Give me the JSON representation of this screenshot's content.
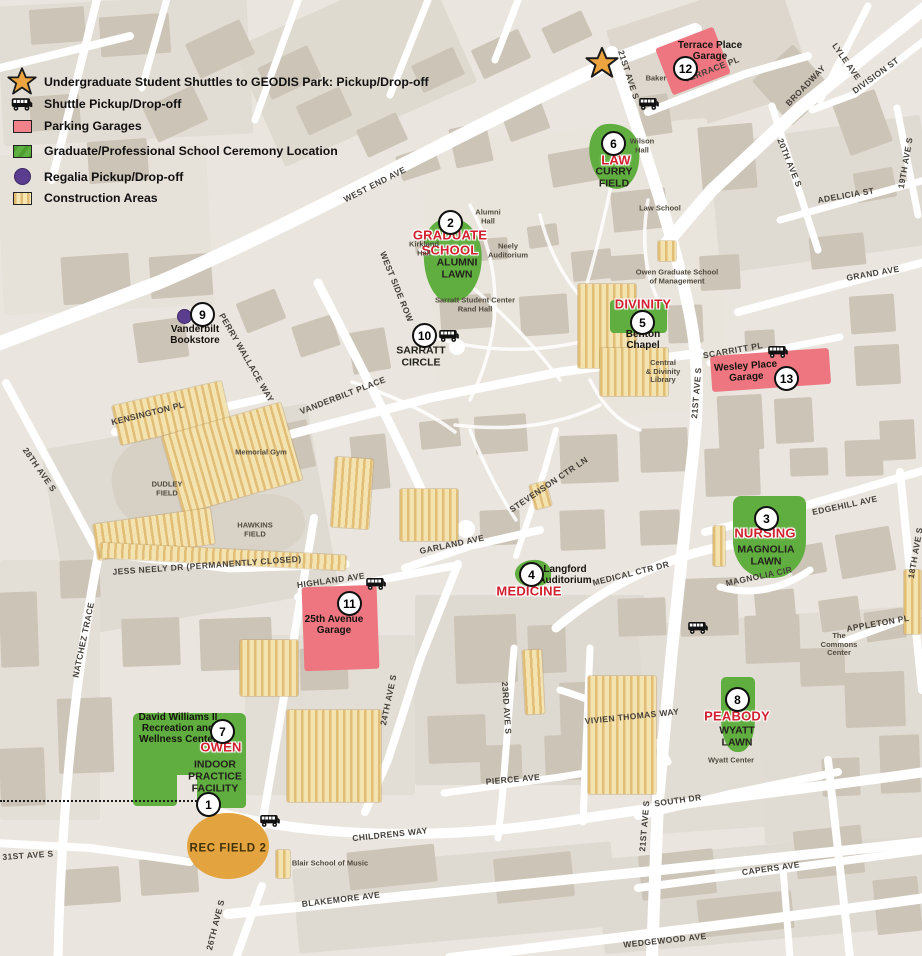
{
  "colors": {
    "ceremony_green": "#5fae3f",
    "garage_pink": "#ee7680",
    "field_orange": "#e3a33e",
    "regalia_purple": "#5b3d8f",
    "star_orange": "#eba43f",
    "red_label": "#d1202f",
    "construction_tan": "#f3e3b1",
    "construction_stripe": "#e1bd75"
  },
  "legend": {
    "items": [
      {
        "icon": "star",
        "label": "Undergraduate Student Shuttles to GEODIS Park: Pickup/Drop-off"
      },
      {
        "icon": "shuttle",
        "label": "Shuttle Pickup/Drop-off"
      },
      {
        "icon": "parking",
        "label": "Parking Garages"
      },
      {
        "icon": "ceremony",
        "label": "Graduate/Professional School Ceremony Location"
      },
      {
        "icon": "regalia",
        "label": "Regalia Pickup/Drop-off"
      },
      {
        "icon": "construction",
        "label": "Construction Areas"
      }
    ]
  },
  "map": {
    "markers": [
      {
        "n": "1",
        "x": 208,
        "y": 804
      },
      {
        "n": "2",
        "x": 450,
        "y": 222
      },
      {
        "n": "3",
        "x": 766,
        "y": 518
      },
      {
        "n": "4",
        "x": 531,
        "y": 574
      },
      {
        "n": "5",
        "x": 642,
        "y": 322
      },
      {
        "n": "6",
        "x": 613,
        "y": 143
      },
      {
        "n": "7",
        "x": 222,
        "y": 731
      },
      {
        "n": "8",
        "x": 737,
        "y": 699
      },
      {
        "n": "9",
        "x": 202,
        "y": 314
      },
      {
        "n": "10",
        "x": 424,
        "y": 335
      },
      {
        "n": "11",
        "x": 349,
        "y": 603
      },
      {
        "n": "12",
        "x": 685,
        "y": 68
      },
      {
        "n": "13",
        "x": 786,
        "y": 378
      }
    ],
    "shuttle_stops": [
      {
        "x": 649,
        "y": 106
      },
      {
        "x": 449,
        "y": 338
      },
      {
        "x": 778,
        "y": 354
      },
      {
        "x": 376,
        "y": 586
      },
      {
        "x": 698,
        "y": 630
      },
      {
        "x": 270,
        "y": 823
      }
    ],
    "stars": [
      {
        "x": 602,
        "y": 66,
        "size": 34
      }
    ],
    "regalia_stops": [
      {
        "x": 183,
        "y": 315
      }
    ],
    "place_labels": [
      {
        "t": [
          "GRADUATE",
          "SCHOOL"
        ],
        "x": 450,
        "y": 243,
        "s": "red"
      },
      {
        "t": [
          "ALUMNI",
          "LAWN"
        ],
        "x": 457,
        "y": 269,
        "s": "cap"
      },
      {
        "t": [
          "LAW"
        ],
        "x": 616,
        "y": 161,
        "s": "red"
      },
      {
        "t": [
          "CURRY",
          "FIELD"
        ],
        "x": 614,
        "y": 178,
        "s": "cap"
      },
      {
        "t": [
          "DIVINITY"
        ],
        "x": 643,
        "y": 305,
        "s": "red"
      },
      {
        "t": [
          "Benton",
          "Chapel"
        ],
        "x": 643,
        "y": 340,
        "s": "bold"
      },
      {
        "t": [
          "NURSING"
        ],
        "x": 765,
        "y": 534,
        "s": "red"
      },
      {
        "t": [
          "MAGNOLIA",
          "LAWN"
        ],
        "x": 766,
        "y": 556,
        "s": "cap"
      },
      {
        "t": [
          "MEDICINE"
        ],
        "x": 529,
        "y": 592,
        "s": "red"
      },
      {
        "t": [
          "Langford",
          "Auditorium"
        ],
        "x": 565,
        "y": 575,
        "s": "bold"
      },
      {
        "t": [
          "OWEN"
        ],
        "x": 221,
        "y": 748,
        "s": "red"
      },
      {
        "t": [
          "David Williams II",
          "Recreation and",
          "Wellness Center"
        ],
        "x": 178,
        "y": 729,
        "s": "bold"
      },
      {
        "t": [
          "INDOOR",
          "PRACTICE",
          "FACILITY"
        ],
        "x": 215,
        "y": 777,
        "s": "cap"
      },
      {
        "t": [
          "PEABODY"
        ],
        "x": 737,
        "y": 717,
        "s": "red"
      },
      {
        "t": [
          "WYATT",
          "LAWN"
        ],
        "x": 737,
        "y": 737,
        "s": "cap"
      },
      {
        "t": [
          "Vanderbilt",
          "Bookstore"
        ],
        "x": 195,
        "y": 335,
        "s": "bold"
      },
      {
        "t": [
          "SARRATT",
          "CIRCLE"
        ],
        "x": 421,
        "y": 357,
        "s": "cap"
      },
      {
        "t": [
          "25th Avenue",
          "Garage"
        ],
        "x": 334,
        "y": 625,
        "s": "bold"
      },
      {
        "t": [
          "Terrace Place",
          "Garage"
        ],
        "x": 710,
        "y": 51,
        "s": "bold"
      },
      {
        "t": [
          "Wesley Place",
          "Garage"
        ],
        "x": 746,
        "y": 372,
        "s": "bold",
        "r": -4
      },
      {
        "t": [
          "REC FIELD 2"
        ],
        "x": 228,
        "y": 849,
        "s": "fieldlbl"
      },
      {
        "t": [
          "Wilson",
          "Hall"
        ],
        "x": 642,
        "y": 146,
        "s": "tiny"
      },
      {
        "t": [
          "Baker"
        ],
        "x": 656,
        "y": 79,
        "s": "tiny"
      },
      {
        "t": [
          "Kirkland",
          "Hall"
        ],
        "x": 424,
        "y": 249,
        "s": "tiny"
      },
      {
        "t": [
          "Alumni",
          "Hall"
        ],
        "x": 488,
        "y": 217,
        "s": "tiny"
      },
      {
        "t": [
          "Neely",
          "Auditorium"
        ],
        "x": 508,
        "y": 251,
        "s": "tiny"
      },
      {
        "t": [
          "Law School"
        ],
        "x": 660,
        "y": 209,
        "s": "tiny"
      },
      {
        "t": [
          "Owen Graduate School",
          "of Management"
        ],
        "x": 677,
        "y": 277,
        "s": "tiny"
      },
      {
        "t": [
          "Central",
          "& Divinity",
          "Library"
        ],
        "x": 663,
        "y": 372,
        "s": "tiny"
      },
      {
        "t": [
          "Sarratt Student Center",
          "Rand Hall"
        ],
        "x": 475,
        "y": 305,
        "s": "tiny"
      },
      {
        "t": [
          "Memorial Gym"
        ],
        "x": 261,
        "y": 453,
        "s": "tiny"
      },
      {
        "t": [
          "DUDLEY",
          "FIELD"
        ],
        "x": 167,
        "y": 489,
        "s": "tiny"
      },
      {
        "t": [
          "HAWKINS",
          "FIELD"
        ],
        "x": 255,
        "y": 530,
        "s": "tiny"
      },
      {
        "t": [
          "The",
          "Commons",
          "Center"
        ],
        "x": 839,
        "y": 645,
        "s": "tiny"
      },
      {
        "t": [
          "Wyatt Center"
        ],
        "x": 731,
        "y": 761,
        "s": "tiny"
      },
      {
        "t": [
          "Blair School of Music"
        ],
        "x": 330,
        "y": 864,
        "s": "tiny"
      }
    ],
    "street_labels": [
      {
        "t": "WEST END AVE",
        "x": 375,
        "y": 185,
        "r": -27
      },
      {
        "t": "21ST AVE S",
        "x": 628,
        "y": 75,
        "r": 72
      },
      {
        "t": "TERRACE PL",
        "x": 712,
        "y": 70,
        "r": -21
      },
      {
        "t": "BROADWAY",
        "x": 806,
        "y": 86,
        "r": -46
      },
      {
        "t": "LYLE AVE",
        "x": 846,
        "y": 62,
        "r": 55
      },
      {
        "t": "DIVISION ST",
        "x": 876,
        "y": 76,
        "r": -36
      },
      {
        "t": "20TH AVE S",
        "x": 789,
        "y": 163,
        "r": 68
      },
      {
        "t": "19TH AVE S",
        "x": 906,
        "y": 163,
        "r": -80
      },
      {
        "t": "ADELICIA ST",
        "x": 846,
        "y": 196,
        "r": -10
      },
      {
        "t": "GRAND AVE",
        "x": 873,
        "y": 274,
        "r": -10
      },
      {
        "t": "SCARRITT PL",
        "x": 733,
        "y": 351,
        "r": -10
      },
      {
        "t": "21ST AVE S",
        "x": 697,
        "y": 393,
        "r": -85
      },
      {
        "t": "WEST SIDE ROW",
        "x": 396,
        "y": 287,
        "r": 68
      },
      {
        "t": "VANDERBILT PLACE",
        "x": 343,
        "y": 396,
        "r": -21
      },
      {
        "t": "PERRY WALLACE WAY",
        "x": 246,
        "y": 358,
        "r": 60
      },
      {
        "t": "KENSINGTON PL",
        "x": 148,
        "y": 414,
        "r": -14
      },
      {
        "t": "28TH AVE S",
        "x": 39,
        "y": 470,
        "r": 55
      },
      {
        "t": "NATCHEZ TRACE",
        "x": 84,
        "y": 640,
        "r": -78
      },
      {
        "t": "JESS NEELY DR  (PERMANENTLY CLOSED)",
        "x": 207,
        "y": 566,
        "r": -4
      },
      {
        "t": "HIGHLAND AVE",
        "x": 331,
        "y": 581,
        "r": -8
      },
      {
        "t": "GARLAND AVE",
        "x": 452,
        "y": 545,
        "r": -12
      },
      {
        "t": "STEVENSON CTR LN",
        "x": 549,
        "y": 485,
        "r": -34
      },
      {
        "t": "MEDICAL CTR DR",
        "x": 631,
        "y": 574,
        "r": -14
      },
      {
        "t": "MAGNOLIA CIR",
        "x": 759,
        "y": 577,
        "r": -12
      },
      {
        "t": "EDGEHILL AVE",
        "x": 845,
        "y": 506,
        "r": -12
      },
      {
        "t": "18TH AVE S",
        "x": 916,
        "y": 553,
        "r": -80
      },
      {
        "t": "APPLETON PL",
        "x": 878,
        "y": 624,
        "r": -10
      },
      {
        "t": "VIVIEN THOMAS WAY",
        "x": 632,
        "y": 717,
        "r": -6
      },
      {
        "t": "SOUTH DR",
        "x": 678,
        "y": 801,
        "r": -8
      },
      {
        "t": "21ST AVE S",
        "x": 645,
        "y": 826,
        "r": -85
      },
      {
        "t": "PIERCE AVE",
        "x": 513,
        "y": 780,
        "r": -5
      },
      {
        "t": "23RD AVE S",
        "x": 506,
        "y": 708,
        "r": 86
      },
      {
        "t": "24TH AVE S",
        "x": 389,
        "y": 700,
        "r": -78
      },
      {
        "t": "CHILDRENS WAY",
        "x": 390,
        "y": 835,
        "r": -6
      },
      {
        "t": "31ST AVE S",
        "x": 28,
        "y": 856,
        "r": -4
      },
      {
        "t": "BLAKEMORE AVE",
        "x": 341,
        "y": 900,
        "r": -7
      },
      {
        "t": "WEDGEWOOD AVE",
        "x": 665,
        "y": 941,
        "r": -6
      },
      {
        "t": "CAPERS AVE",
        "x": 771,
        "y": 869,
        "r": -8
      },
      {
        "t": "26TH AVE S",
        "x": 216,
        "y": 925,
        "r": -76
      }
    ]
  }
}
